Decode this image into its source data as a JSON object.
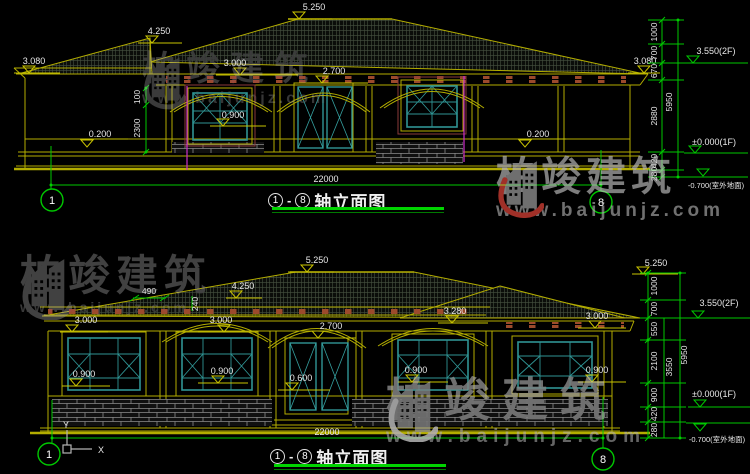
{
  "watermark": {
    "brand": "柏竣建筑",
    "url": "www.baijunjz.com"
  },
  "ucs": {
    "x_label": "X",
    "y_label": "Y"
  },
  "elevation_top": {
    "bubble_left": "1",
    "bubble_right": "8",
    "title": {
      "from": "1",
      "sep": "-",
      "to": "8",
      "name": "轴立面图"
    },
    "overall_width": "22000",
    "labels": {
      "ridge": "5.250",
      "wing_ridge": "4.250",
      "eave_left": "3.080",
      "eave_right": "3.080",
      "window_head": "3.000",
      "door_head": "2.700",
      "window_sill": "0.900",
      "plinth_left": "0.200",
      "plinth_right": "0.200",
      "dim_100": "100",
      "dim_2300": "2300",
      "level_2f": "3.550(2F)",
      "level_1f": "±0.000(1F)",
      "level_ground": "-0.700(室外地面)"
    },
    "chain": [
      "1000",
      "700",
      "670",
      "2880",
      "420",
      "280"
    ],
    "chain_total": "5950"
  },
  "elevation_bottom": {
    "bubble_left": "1",
    "bubble_right": "8",
    "title": {
      "from": "1",
      "sep": "-",
      "to": "8",
      "name": "轴立面图"
    },
    "overall_width": "22000",
    "labels": {
      "ridge": "5.250",
      "ridge_right": "5.250",
      "wing_ridge": "4.250",
      "dim_490": "490",
      "dim_240": "240",
      "win1_head": "3.000",
      "win2_head": "3.000",
      "door_head": "2.700",
      "win3_head": "3.280",
      "win4_head": "3.000",
      "win1_sill": "0.900",
      "win2_sill": "0.900",
      "door_sill": "0.600",
      "win3_sill": "0.900",
      "win4_sill": "0.900",
      "level_2f": "3.550(2F)",
      "level_1f": "±0.000(1F)",
      "level_ground": "-0.700(室外地面)"
    },
    "chain": [
      "1000",
      "700",
      "550",
      "2100",
      "900",
      "420",
      "280"
    ],
    "chain_mid": "3550",
    "chain_total": "5950"
  }
}
